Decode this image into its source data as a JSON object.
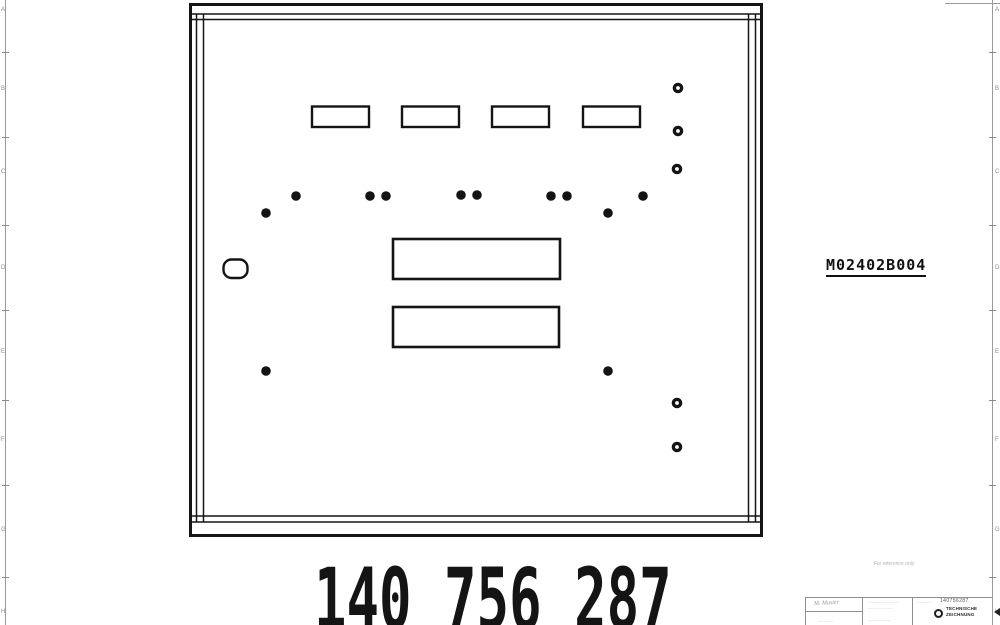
{
  "frame": {
    "left_zone_letters": [
      "A",
      "B",
      "C",
      "D",
      "E",
      "F",
      "G",
      "H"
    ],
    "right_zone_letters": [
      "A",
      "B",
      "C",
      "D",
      "E",
      "F",
      "G",
      "H"
    ],
    "letter_ys": [
      10,
      89,
      172,
      268,
      352,
      440,
      530,
      612
    ],
    "tick_ys": [
      52,
      137,
      225,
      310,
      400,
      485,
      577
    ]
  },
  "drawing": {
    "part_ref": "M02402B004",
    "big_number": "140 756 287",
    "watermark": "For reference only",
    "line_color": "#141414",
    "panel": {
      "outer": {
        "x": 190.5,
        "y": 4.5,
        "w": 571,
        "h": 531,
        "stroke_w": 3
      },
      "inner_h_ys": [
        14,
        19.5,
        516,
        522
      ],
      "inner_v_xs": [
        196.5,
        203.5,
        748.5,
        755.5
      ],
      "inner_h_x1": 192,
      "inner_h_x2": 760,
      "inner_v_y1": 14,
      "inner_v_y2": 522
    },
    "slots": {
      "y": 106.5,
      "w": 57,
      "h": 20.5,
      "xs": [
        312,
        402,
        492,
        583
      ],
      "stroke_w": 2.4
    },
    "cutouts": [
      {
        "x": 393,
        "y": 239,
        "w": 167,
        "h": 40
      },
      {
        "x": 393,
        "y": 307,
        "w": 166,
        "h": 40
      }
    ],
    "obround": {
      "x": 223.5,
      "y": 259.5,
      "w": 24,
      "h": 18.5,
      "rx": 8,
      "stroke_w": 2.4
    },
    "dots": [
      [
        266,
        213
      ],
      [
        296,
        196
      ],
      [
        370,
        196
      ],
      [
        386,
        196
      ],
      [
        461,
        195
      ],
      [
        477,
        195
      ],
      [
        551,
        196
      ],
      [
        567,
        196
      ],
      [
        608,
        213
      ],
      [
        643,
        196
      ],
      [
        266,
        371
      ],
      [
        608,
        371
      ]
    ],
    "dot_r": 4.8,
    "ring_holes": [
      [
        678,
        88
      ],
      [
        678,
        131
      ],
      [
        677,
        169
      ],
      [
        677,
        403
      ],
      [
        677,
        447
      ]
    ],
    "ring_r": 3.6,
    "ring_stroke_w": 3.4
  },
  "title_block": {
    "doc_number": "140756287",
    "signature": "M. Muster",
    "cell_mid_line1": "............................",
    "cell_mid_line2": ".......................",
    "cell_right_text": "..............",
    "company_line1": "TECHNISCHE",
    "company_line2": "ZEICHNUNG",
    "footer_micro_left": "..............",
    "footer_micro_mid": "....................."
  }
}
